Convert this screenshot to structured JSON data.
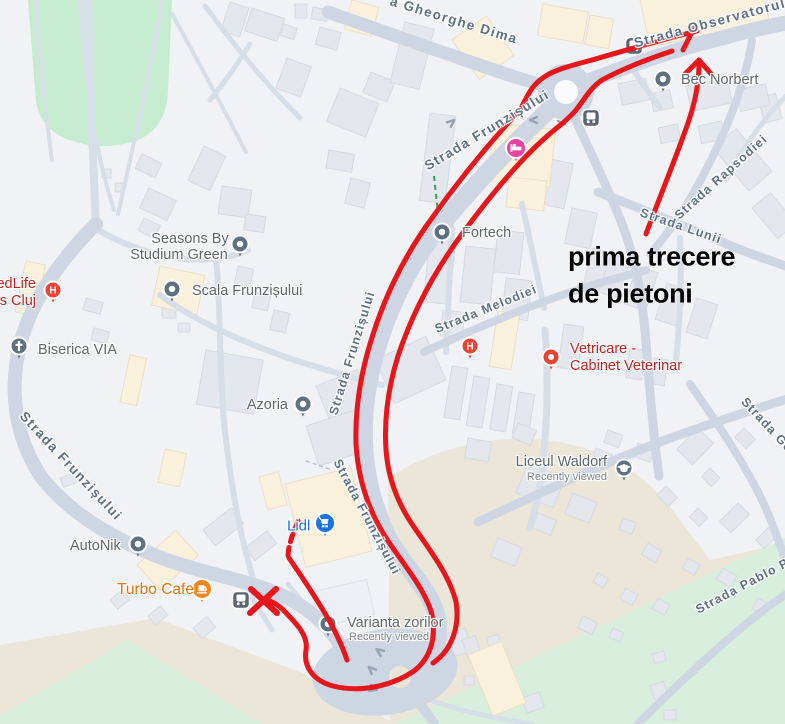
{
  "colors": {
    "background": "#f1f2f5",
    "road": "#cdd6e2",
    "road_minor": "#d6dee8",
    "building": "#e4e7ed",
    "building_border": "#d6dae2",
    "building_cream": "#faf1dc",
    "building_cream_border": "#ecdfc4",
    "park_green": "#c5eccf",
    "field_green": "#d8efdd",
    "beige": "#ece6d9",
    "annotation_red": "#e8151a",
    "annotation_text": "#000000",
    "street_label": "#5d7186",
    "poi_label": "#5f676e",
    "poi_sub": "#80868b",
    "red_poi": "#c5221f",
    "orange_poi": "#e8710a",
    "blue_poi": "#1a73e8",
    "pin_gray": "#5f7081",
    "pin_red": "#ea4335",
    "pin_pink": "#ec3fa2",
    "pin_orange": "#f0861f",
    "bus_icon": "#5b6472",
    "road_arrow": "#97a3b3",
    "path_green": "#2fa257"
  },
  "streets": {
    "gheorghe_dima": "a Gheorghe Dima",
    "observatorului": "Strada Observatorului",
    "frunzisului_top": "Strada Frunzișului",
    "frunzisului_mid1": "Strada Frunzișului",
    "frunzisului_mid2": "Strada Frunzișului",
    "frunzisului_left": "Strada Frunzișului",
    "melodiei": "Strada Melodiei",
    "lunii": "Strada Lunii",
    "rapsodiei": "Strada Rapsodiei",
    "geo": "Strada Geo",
    "pablo": "Strada Pablo Pic"
  },
  "pois": {
    "medlife_l1": "edLife",
    "medlife_l2": "s Cluj",
    "seasons_l1": "Seasons By",
    "seasons_l2": "Studium Green",
    "scala": "Scala Frunzișului",
    "biserica": "Biserica VIA",
    "azoria": "Azoria",
    "autonik": "AutoNik",
    "turbo": "Turbo Cafe",
    "lidl": "Lidl",
    "fortech": "Fortech",
    "bec": "Bec Norbert",
    "vetricare_l1": "Vetricare -",
    "vetricare_l2": "Cabinet Veterinar",
    "waldorf": "Liceul Waldorf",
    "waldorf_sub": "Recently viewed",
    "varianta": "Varianta zorilor",
    "varianta_sub": "Recently viewed"
  },
  "icons": {
    "hospital_letter": "H"
  },
  "annotation": {
    "line1": "prima trecere",
    "line2": "de pietoni"
  }
}
